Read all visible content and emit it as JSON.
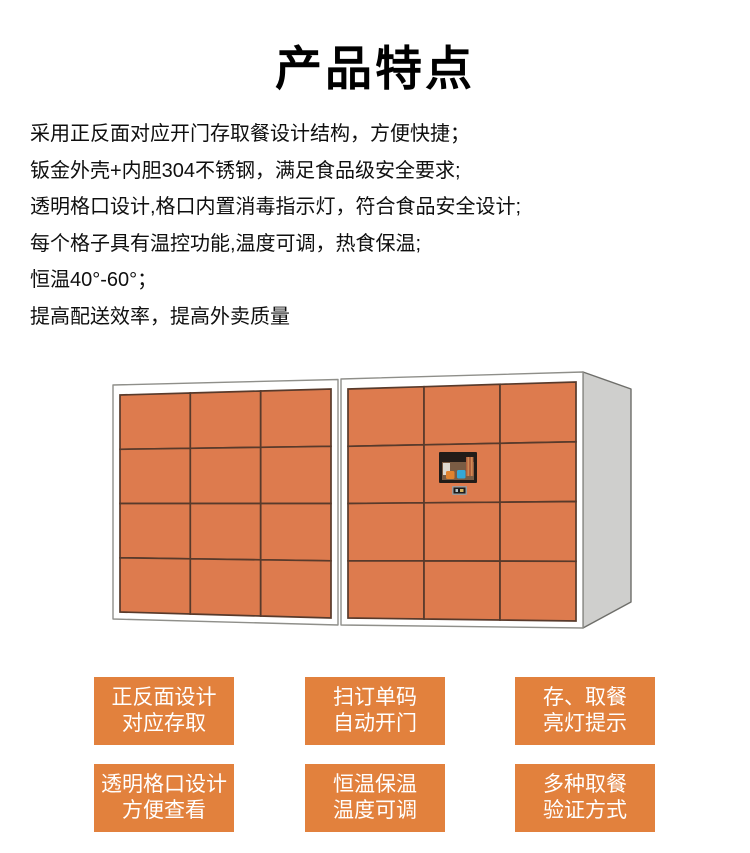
{
  "title": "产品特点",
  "features": [
    "采用正反面对应开门存取餐设计结构，方便快捷；",
    "钣金外壳+内胆304不锈钢，满足食品级安全要求;",
    "透明格口设计,格口内置消毒指示灯，符合食品安全设计;",
    "每个格子具有温控功能,温度可调，热食保温;",
    "恒温40°-60°；",
    "提高配送效率，提高外卖质量"
  ],
  "locker": {
    "units": 2,
    "rows": 4,
    "cols": 3,
    "door_color": "#dd7b4e",
    "divider_color": "#583a2b",
    "frame_color": "#ffffff",
    "frame_stroke": "#8f8f8a",
    "side_color": "#cfcfcd",
    "side_stroke": "#6e6e6a",
    "screen": {
      "frame_color": "#221c18",
      "bg_color": "#7a5c44",
      "ceiling_color": "#241c18",
      "panel_color": "#ddd8cf",
      "accent_orange": "#e0832f",
      "accent_blue": "#35a8d8",
      "stripe_color": "#b0603c",
      "stripe_light": "#cf8a55"
    },
    "scanner_outer": "#9a9a9a",
    "scanner_inner": "#1c1c1c",
    "scanner_dot1": "#b8c4c8",
    "scanner_dot2": "#d8b05e"
  },
  "feature_tags": [
    {
      "line1": "正反面设计",
      "line2": "对应存取"
    },
    {
      "line1": "扫订单码",
      "line2": "自动开门"
    },
    {
      "line1": "存、取餐",
      "line2": "亮灯提示"
    },
    {
      "line1": "透明格口设计",
      "line2": "方便查看"
    },
    {
      "line1": "恒温保温",
      "line2": "温度可调"
    },
    {
      "line1": "多种取餐",
      "line2": "验证方式"
    }
  ],
  "tag_color": "#e2813d",
  "tag_text_color": "#ffffff"
}
